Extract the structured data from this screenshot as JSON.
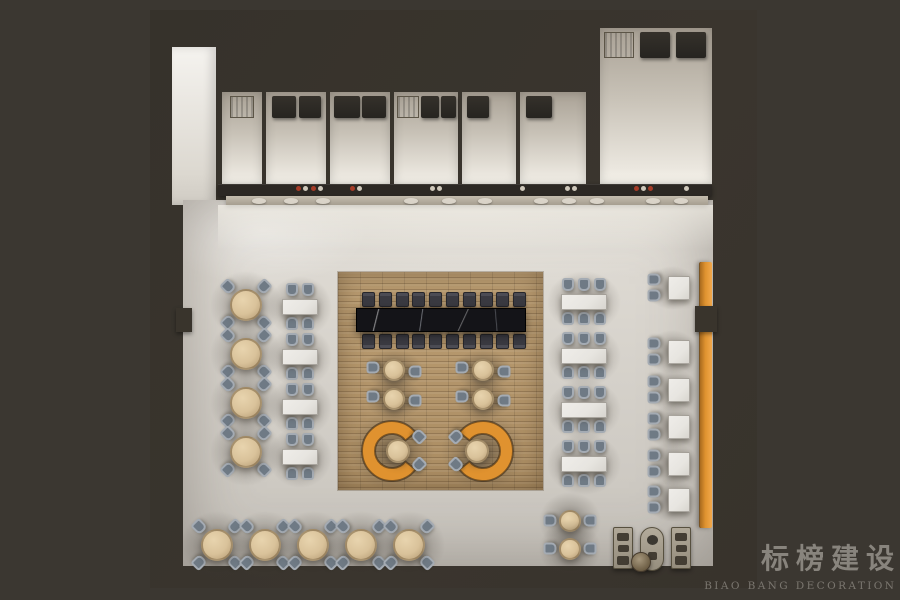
{
  "watermark": {
    "title": "标榜建设",
    "subtitle": "BIAO BANG DECORATION"
  },
  "palette": {
    "background": "#3b3731",
    "wall_dark": "#36322b",
    "corridor_white": "#f1efe9",
    "floor_light": "#d9d5ce",
    "stall_interior": "#d9d4cb",
    "appliance_dark": "#2b2823",
    "appliance_vent": "#a4998a",
    "counter_dark": "#2c2824",
    "wood_floor": "#b2946a",
    "marble_black": "#141418",
    "chair_gray": "#a4abb3",
    "chair_gray_dark": "#6f7a85",
    "chair_charcoal": "#3c3c42",
    "table_beige": "#d9c29a",
    "table_beige_dark": "#b49a73",
    "table_white": "#e7e5e0",
    "booth_orange": "#e0922f",
    "banquette_orange": "#df9330",
    "food_red": "#a63c28",
    "watermark_text": "#8f8b84",
    "watermark_sub": "#807c75"
  },
  "scene": {
    "food_stalls": 7,
    "communal_table_seats_per_side": 10,
    "left_round_tables": 4,
    "left_rect_tables": 4,
    "right_rect_tables": 4,
    "banquette_tables": 6,
    "island_small_tables": 4,
    "booths": 2,
    "bottom_round_tables": 5,
    "bottom_pair_tables": 2,
    "service_stations": 3
  }
}
